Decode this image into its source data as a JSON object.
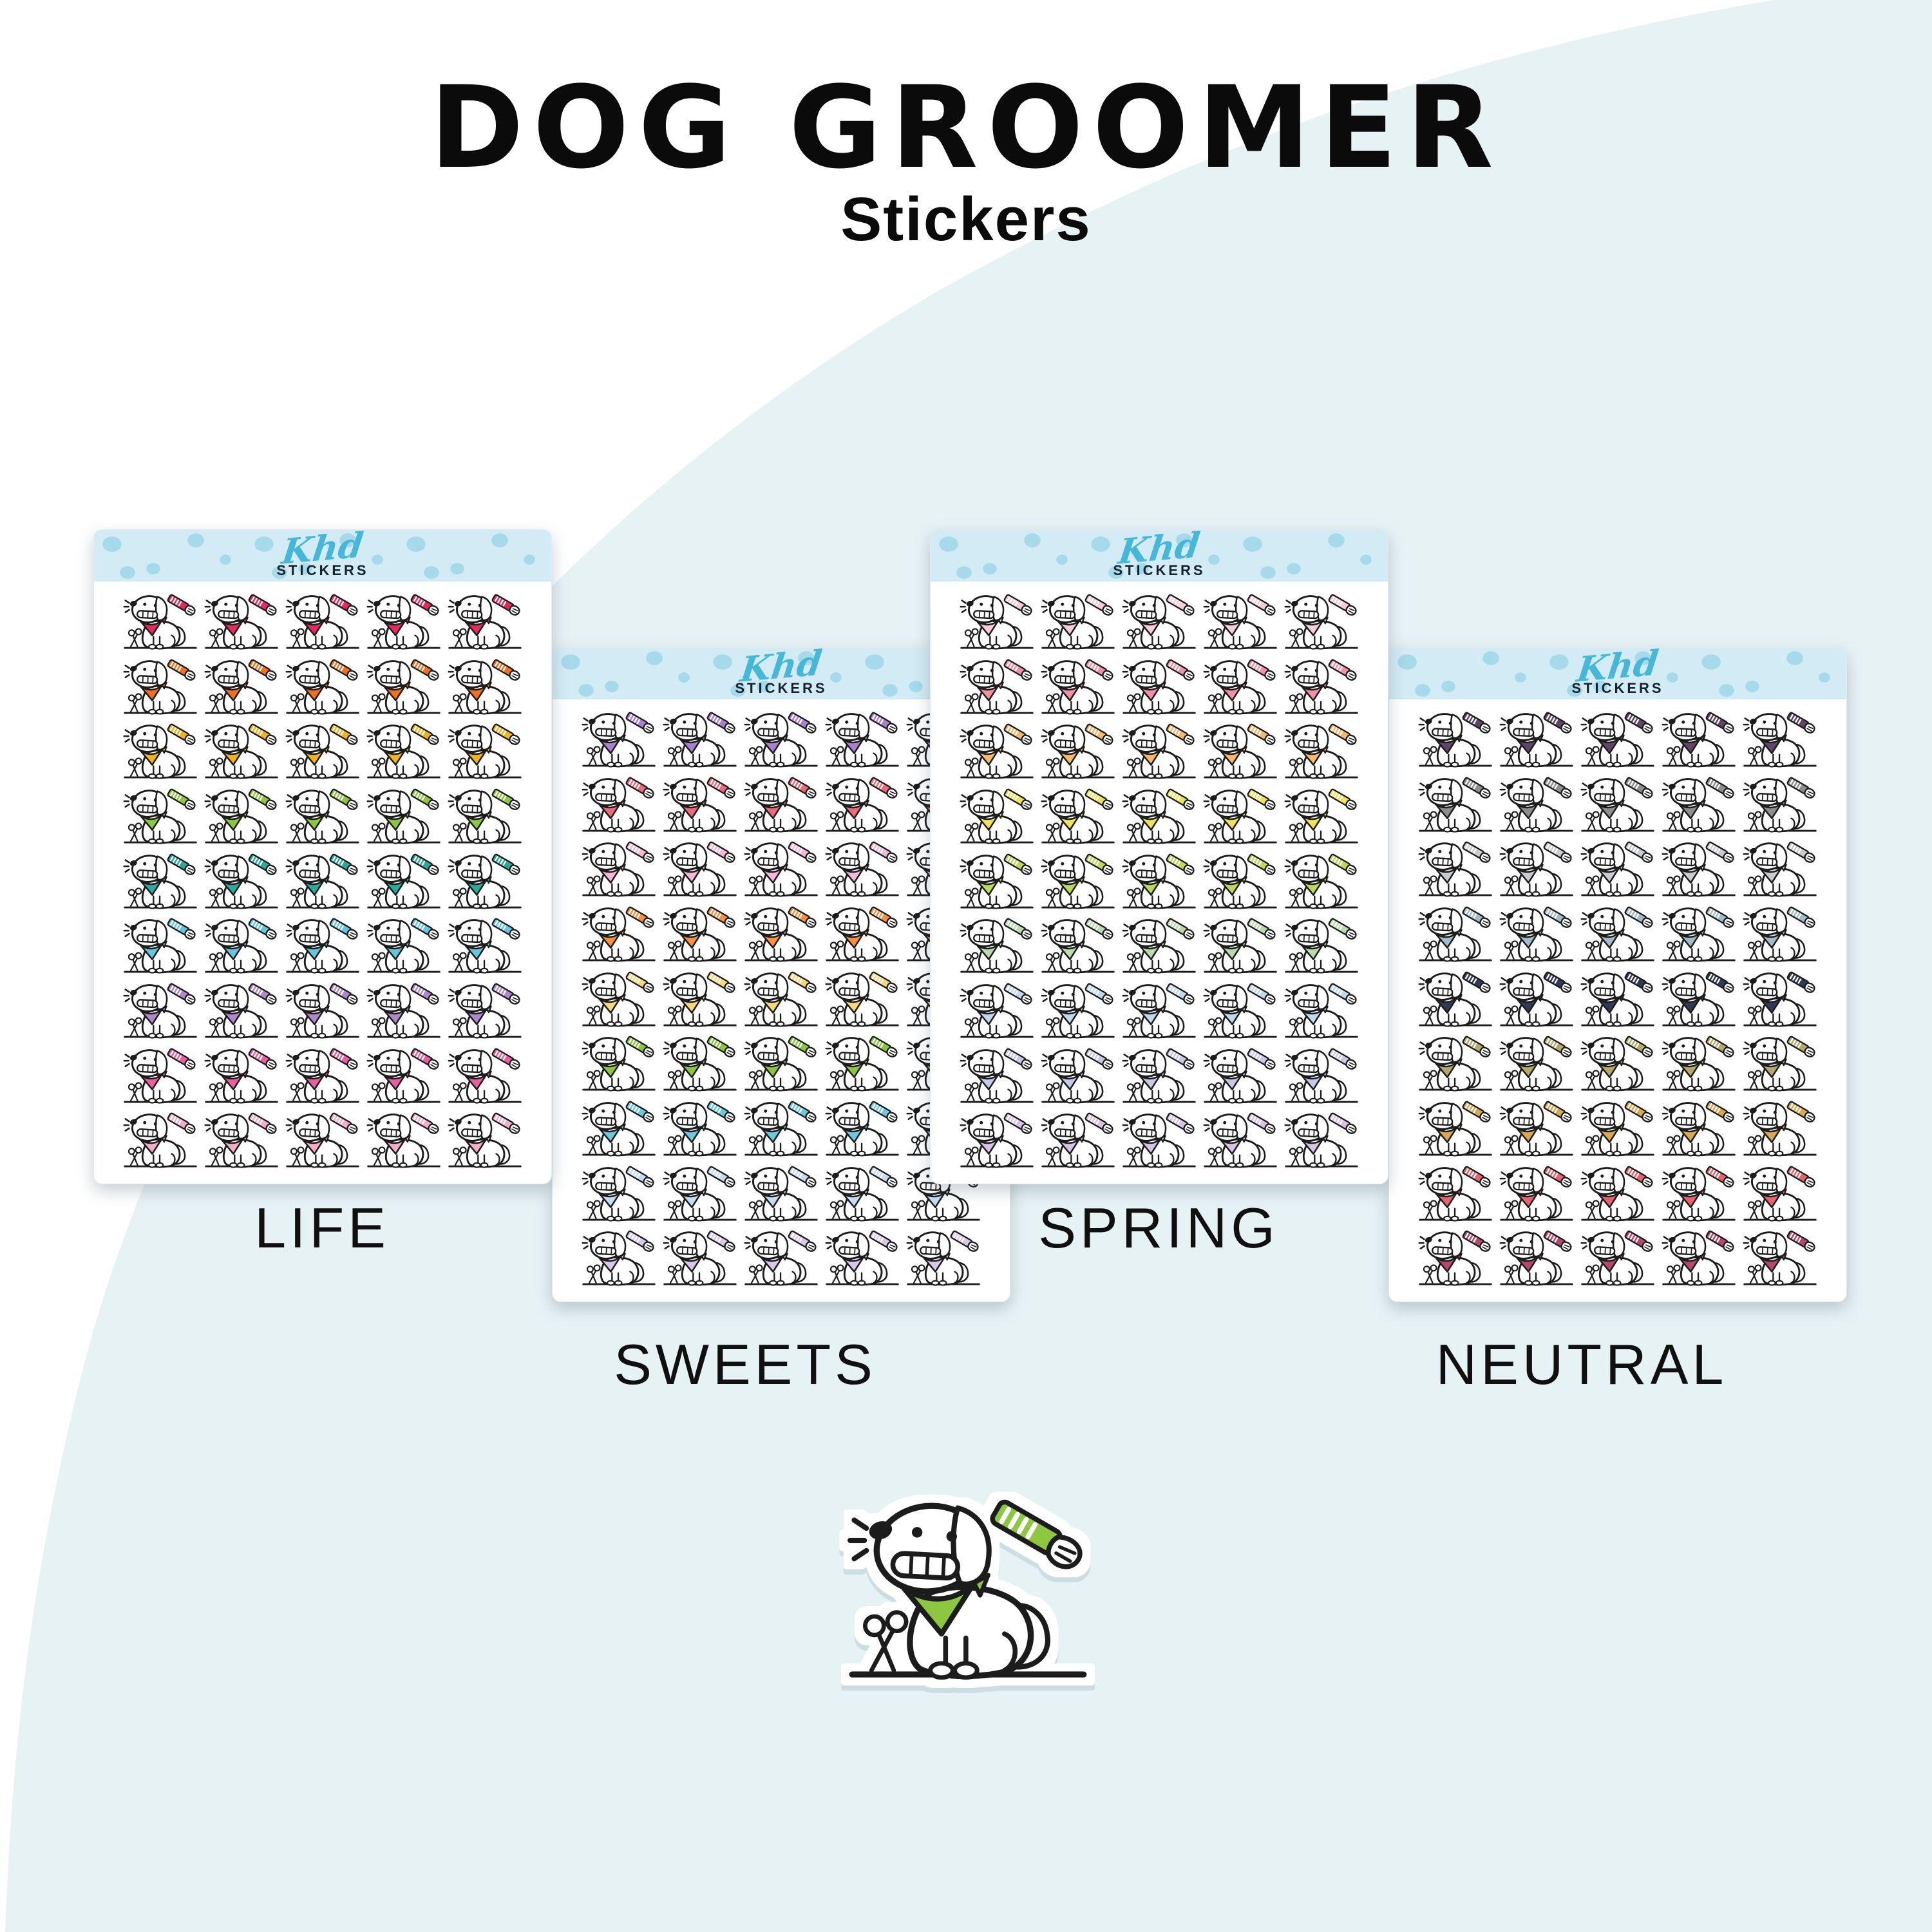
{
  "title": "DOG GROOMER",
  "subtitle": "Stickers",
  "brand": {
    "logo_script": "Khd",
    "logo_sub": "STICKERS"
  },
  "grid": {
    "columns": 5,
    "rows": 9,
    "stickers_per_sheet": 45
  },
  "sheets": [
    {
      "id": "life",
      "label": "LIFE",
      "row_colors": [
        "#e52a5c",
        "#f3701e",
        "#f2b31f",
        "#8dc63f",
        "#2ba99b",
        "#66c5e0",
        "#b089cc",
        "#ea5f9f",
        "#f2aecb"
      ]
    },
    {
      "id": "sweets",
      "label": "SWEETS",
      "row_colors": [
        "#ab7fd1",
        "#f0697a",
        "#f6b8d8",
        "#f59140",
        "#f8d87c",
        "#8cc63e",
        "#6ec9de",
        "#c4dcf5",
        "#d9c7ec"
      ]
    },
    {
      "id": "spring",
      "label": "SPRING",
      "row_colors": [
        "#f8ccd8",
        "#f391a4",
        "#f8b96d",
        "#f2e25b",
        "#bcd85d",
        "#b8dcab",
        "#c0d9f0",
        "#c6c9e8",
        "#d8c3e6"
      ]
    },
    {
      "id": "neutral",
      "label": "NEUTRAL",
      "row_colors": [
        "#5f4668",
        "#8e8e8e",
        "#c9cdd1",
        "#a3bcc9",
        "#2f3a56",
        "#b5aa6e",
        "#d9a853",
        "#e8636e",
        "#b5486e"
      ]
    }
  ],
  "hero_sticker": {
    "bandana_color": "#8dc63f",
    "description": "dog with comb, scissors and green bandana"
  },
  "icons": {
    "comb": "comb-icon",
    "scissors": "scissors-icon"
  },
  "colors": {
    "background_blob": "#e7f2f5",
    "band_background": "#d2ebf4",
    "band_dot": "#a6d9e9",
    "logo_teal": "#47b7d8",
    "ink": "#1c1c1c",
    "text": "#0b0b0b"
  }
}
